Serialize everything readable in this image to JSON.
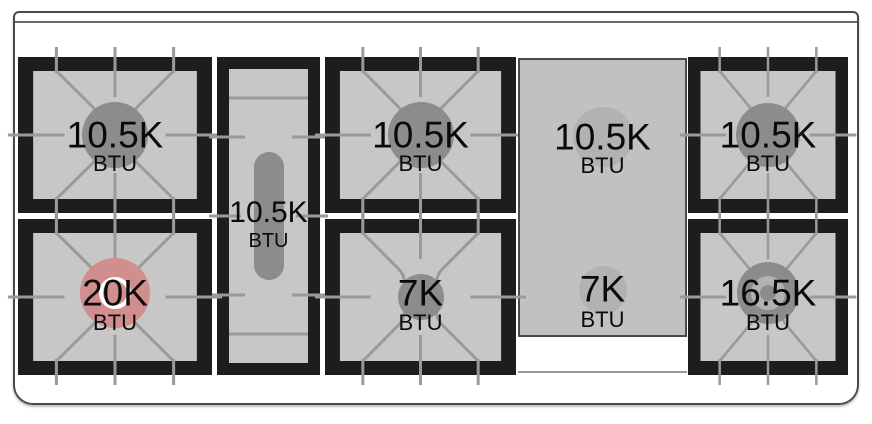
{
  "title": "Cooktop burner layout diagram",
  "colors": {
    "background": "#ffffff",
    "outline_color": "#4a4a4a",
    "frame_color": "#1d1d1d",
    "surface_color": "#c7c7c7",
    "grate_color": "#9a9a9a",
    "burner_circle_color": "#8c8c8c",
    "griddle_color": "#c1c1c1",
    "griddle_ghost_color": "#b2b2b2",
    "highlight_color": "#d18e8e",
    "text_color": "#0a0a0a"
  },
  "cooktop": {
    "burners": [
      {
        "id": "top-left",
        "rating": "10.5K",
        "unit": "BTU",
        "type": "standard",
        "selected": false
      },
      {
        "id": "center-oval",
        "rating": "10.5K",
        "unit": "BTU",
        "type": "oval",
        "selected": false
      },
      {
        "id": "top-center",
        "rating": "10.5K",
        "unit": "BTU",
        "type": "standard",
        "selected": false
      },
      {
        "id": "griddle-rear",
        "rating": "10.5K",
        "unit": "BTU",
        "type": "griddle-zone",
        "selected": false
      },
      {
        "id": "top-right",
        "rating": "10.5K",
        "unit": "BTU",
        "type": "standard",
        "selected": false
      },
      {
        "id": "bottom-left",
        "rating": "20K",
        "unit": "BTU",
        "type": "standard",
        "selected": true
      },
      {
        "id": "bottom-center",
        "rating": "7K",
        "unit": "BTU",
        "type": "standard",
        "selected": false
      },
      {
        "id": "griddle-front",
        "rating": "7K",
        "unit": "BTU",
        "type": "griddle-zone",
        "selected": false
      },
      {
        "id": "bottom-right",
        "rating": "16.5K",
        "unit": "BTU",
        "type": "dual-ring",
        "selected": false
      }
    ]
  }
}
